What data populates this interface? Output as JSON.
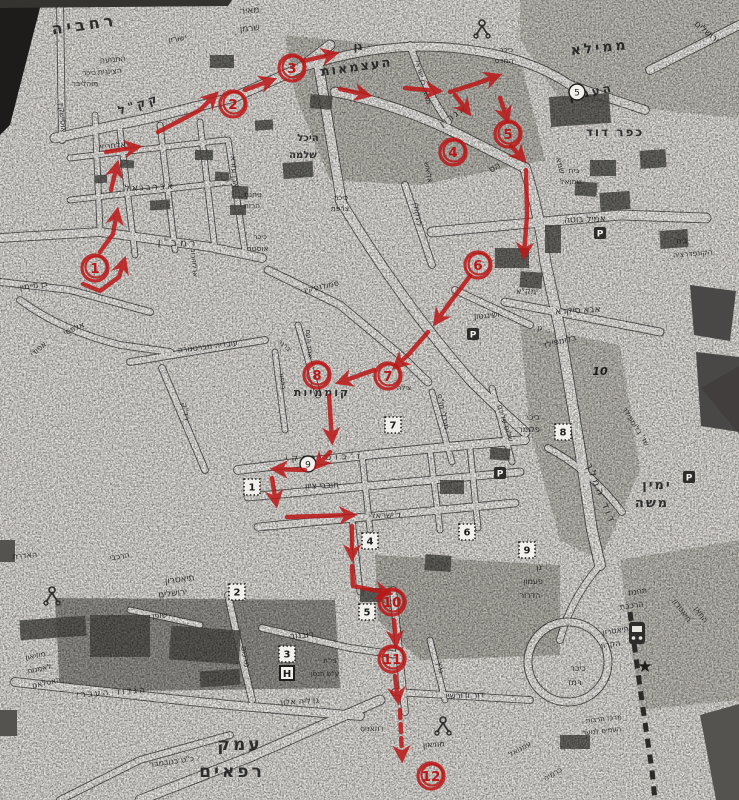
{
  "map_title": "Jerusalem city-center street map (scanned photocopy) with hand-drawn walking route",
  "route": {
    "color": "#bb1717",
    "markers": [
      {
        "n": "1",
        "x": 95,
        "y": 268
      },
      {
        "n": "2",
        "x": 233,
        "y": 104
      },
      {
        "n": "3",
        "x": 292,
        "y": 68
      },
      {
        "n": "4",
        "x": 453,
        "y": 152
      },
      {
        "n": "5",
        "x": 508,
        "y": 134
      },
      {
        "n": "6",
        "x": 478,
        "y": 265
      },
      {
        "n": "7",
        "x": 388,
        "y": 376
      },
      {
        "n": "8",
        "x": 317,
        "y": 375
      },
      {
        "n": "10",
        "x": 392,
        "y": 602
      },
      {
        "n": "11",
        "x": 392,
        "y": 659
      },
      {
        "n": "12",
        "x": 431,
        "y": 776
      }
    ],
    "arrows": [
      {
        "p": [
          [
            83,
            284
          ],
          [
            100,
            291
          ],
          [
            119,
            277
          ],
          [
            124,
            261
          ]
        ]
      },
      {
        "p": [
          [
            100,
            252
          ],
          [
            113,
            234
          ],
          [
            117,
            212
          ]
        ]
      },
      {
        "p": [
          [
            111,
            190
          ],
          [
            117,
            165
          ]
        ]
      },
      {
        "p": [
          [
            106,
            152
          ],
          [
            137,
            147
          ]
        ]
      },
      {
        "p": [
          [
            158,
            132
          ],
          [
            200,
            110
          ],
          [
            215,
            95
          ]
        ]
      },
      {
        "p": [
          [
            245,
            90
          ],
          [
            272,
            80
          ]
        ]
      },
      {
        "p": [
          [
            303,
            61
          ],
          [
            334,
            54
          ]
        ]
      },
      {
        "p": [
          [
            340,
            89
          ],
          [
            367,
            95
          ]
        ]
      },
      {
        "p": [
          [
            405,
            88
          ],
          [
            438,
            91
          ]
        ]
      },
      {
        "p": [
          [
            450,
            92
          ],
          [
            478,
            83
          ],
          [
            497,
            76
          ]
        ]
      },
      {
        "p": [
          [
            455,
            95
          ],
          [
            468,
            112
          ]
        ]
      },
      {
        "p": [
          [
            500,
            98
          ],
          [
            507,
            119
          ]
        ]
      },
      {
        "p": [
          [
            511,
            146
          ],
          [
            523,
            159
          ]
        ]
      },
      {
        "p": [
          [
            526,
            170
          ],
          [
            527,
            215
          ],
          [
            524,
            255
          ]
        ]
      },
      {
        "p": [
          [
            470,
            276
          ],
          [
            448,
            305
          ],
          [
            436,
            322
          ]
        ]
      },
      {
        "p": [
          [
            428,
            332
          ],
          [
            408,
            355
          ],
          [
            396,
            366
          ]
        ]
      },
      {
        "p": [
          [
            374,
            370
          ],
          [
            352,
            378
          ],
          [
            340,
            382
          ]
        ]
      },
      {
        "p": [
          [
            329,
            396
          ],
          [
            332,
            440
          ]
        ]
      },
      {
        "p": [
          [
            330,
            452
          ],
          [
            317,
            466
          ]
        ]
      },
      {
        "p": [
          [
            305,
            470
          ],
          [
            275,
            469
          ]
        ]
      },
      {
        "p": [
          [
            272,
            478
          ],
          [
            276,
            503
          ]
        ]
      },
      {
        "p": [
          [
            287,
            517
          ],
          [
            352,
            515
          ]
        ]
      },
      {
        "p": [
          [
            352,
            526
          ],
          [
            352,
            557
          ]
        ]
      },
      {
        "p": [
          [
            352,
            566
          ],
          [
            353,
            586
          ],
          [
            388,
            593
          ]
        ]
      },
      {
        "p": [
          [
            394,
            620
          ],
          [
            396,
            643
          ]
        ]
      },
      {
        "p": [
          [
            395,
            676
          ],
          [
            398,
            700
          ]
        ]
      },
      {
        "p": [
          [
            400,
            710
          ],
          [
            402,
            758
          ]
        ],
        "d": 1
      }
    ]
  },
  "labels": [
    {
      "t": "רחביה",
      "x": 85,
      "y": 30,
      "r": -8,
      "s": 16,
      "b": 1,
      "ls": 4
    },
    {
      "t": "ממילא",
      "x": 600,
      "y": 52,
      "r": -6,
      "s": 14,
      "b": 1,
      "ls": 3
    },
    {
      "t": "העמק",
      "x": 592,
      "y": 96,
      "r": -12,
      "s": 12,
      "b": 1,
      "ls": 3
    },
    {
      "t": "כפר דוד",
      "x": 615,
      "y": 136,
      "r": 0,
      "s": 12,
      "b": 1,
      "ls": 2
    },
    {
      "t": "ימין",
      "x": 657,
      "y": 489,
      "r": 0,
      "s": 13,
      "b": 1,
      "ls": 2
    },
    {
      "t": "משה",
      "x": 652,
      "y": 507,
      "r": 0,
      "s": 13,
      "b": 1,
      "ls": 2
    },
    {
      "t": "עמק",
      "x": 240,
      "y": 750,
      "r": 0,
      "s": 17,
      "b": 1,
      "ls": 3
    },
    {
      "t": "רפאים",
      "x": 232,
      "y": 777,
      "r": 0,
      "s": 17,
      "b": 1,
      "ls": 3
    },
    {
      "t": "קוממיות",
      "x": 322,
      "y": 396,
      "r": 0,
      "s": 11,
      "b": 1,
      "ls": 2
    },
    {
      "t": "גן",
      "x": 358,
      "y": 50,
      "r": 0,
      "s": 11,
      "b": 1
    },
    {
      "t": "העצמאות",
      "x": 357,
      "y": 71,
      "r": -8,
      "s": 13,
      "b": 1,
      "ls": 2
    },
    {
      "t": "היכל",
      "x": 308,
      "y": 141,
      "r": 0,
      "s": 10,
      "b": 1
    },
    {
      "t": "שלמה",
      "x": 303,
      "y": 158,
      "r": 0,
      "s": 10,
      "b": 1
    },
    {
      "t": "קק\"ל",
      "x": 140,
      "y": 108,
      "r": -18,
      "s": 12,
      "b": 1,
      "ls": 3
    },
    {
      "t": "אלחריזי",
      "x": 113,
      "y": 148,
      "r": -6,
      "s": 8
    },
    {
      "t": "אברבנאל",
      "x": 150,
      "y": 190,
      "r": -3,
      "s": 9,
      "ls": 2
    },
    {
      "t": "רמב\"ן",
      "x": 178,
      "y": 246,
      "r": 2,
      "s": 10,
      "ls": 3
    },
    {
      "t": "אבן עזרא",
      "x": 232,
      "y": 172,
      "r": 85,
      "s": 8
    },
    {
      "t": "בן מיימון",
      "x": 34,
      "y": 288,
      "r": -8,
      "s": 8
    },
    {
      "t": "אלפסי",
      "x": 75,
      "y": 331,
      "r": -25,
      "s": 8
    },
    {
      "t": "אפודי",
      "x": 40,
      "y": 351,
      "r": -40,
      "s": 8
    },
    {
      "t": "עובדיה מברטנורה",
      "x": 208,
      "y": 349,
      "r": -7,
      "s": 8
    },
    {
      "t": "רד\"ק",
      "x": 183,
      "y": 412,
      "r": 80,
      "s": 8
    },
    {
      "t": "סמולנסקין",
      "x": 322,
      "y": 289,
      "r": -12,
      "s": 8
    },
    {
      "t": "אחד העם",
      "x": 307,
      "y": 344,
      "r": 85,
      "s": 7
    },
    {
      "t": "ברנר",
      "x": 283,
      "y": 347,
      "r": 40,
      "s": 7
    },
    {
      "t": "בלפור",
      "x": 280,
      "y": 381,
      "r": 85,
      "s": 7
    },
    {
      "t": "ישורון",
      "x": 178,
      "y": 41,
      "r": -10,
      "s": 8
    },
    {
      "t": "מאיר",
      "x": 250,
      "y": 13,
      "r": -5,
      "s": 9
    },
    {
      "t": "שרמן",
      "x": 250,
      "y": 31,
      "r": -5,
      "s": 9
    },
    {
      "t": "כיכר",
      "x": 89,
      "y": 75,
      "r": 0,
      "s": 7.5
    },
    {
      "t": "מוהליבר",
      "x": 85,
      "y": 86,
      "r": 0,
      "s": 7.5
    },
    {
      "t": "התנועה",
      "x": 113,
      "y": 62,
      "r": -5,
      "s": 8
    },
    {
      "t": "הציונית",
      "x": 110,
      "y": 74,
      "r": -5,
      "s": 8
    },
    {
      "t": "אוסישקין",
      "x": 60,
      "y": 118,
      "r": 85,
      "s": 8
    },
    {
      "t": "טחנת",
      "x": 253,
      "y": 197,
      "r": 0,
      "s": 7.5
    },
    {
      "t": "הרוח",
      "x": 252,
      "y": 208,
      "r": 0,
      "s": 7.5
    },
    {
      "t": "כיכר",
      "x": 260,
      "y": 239,
      "r": 0,
      "s": 7.5
    },
    {
      "t": "אוסטר",
      "x": 258,
      "y": 251,
      "r": 0,
      "s": 7.5
    },
    {
      "t": "ארלוזורוב",
      "x": 192,
      "y": 263,
      "r": 85,
      "s": 7
    },
    {
      "t": "כיכר",
      "x": 341,
      "y": 200,
      "r": 0,
      "s": 7.5
    },
    {
      "t": "צרפת",
      "x": 340,
      "y": 211,
      "r": 0,
      "s": 7.5
    },
    {
      "t": "אגרון",
      "x": 455,
      "y": 118,
      "r": -35,
      "s": 10,
      "ls": 2
    },
    {
      "t": "מנשה בן ישראל",
      "x": 421,
      "y": 82,
      "r": 75,
      "s": 7
    },
    {
      "t": "כיכר",
      "x": 506,
      "y": 52,
      "r": 0,
      "s": 7.5
    },
    {
      "t": "המכס",
      "x": 504,
      "y": 63,
      "r": 0,
      "s": 7.5
    },
    {
      "t": "ירושלים",
      "x": 705,
      "y": 34,
      "r": 40,
      "s": 9
    },
    {
      "t": "לינקולן",
      "x": 415,
      "y": 215,
      "r": 80,
      "s": 8
    },
    {
      "t": "אליאש",
      "x": 426,
      "y": 173,
      "r": 80,
      "s": 7.5
    },
    {
      "t": "הס",
      "x": 496,
      "y": 170,
      "r": -30,
      "s": 9
    },
    {
      "t": "שמא",
      "x": 558,
      "y": 166,
      "r": 75,
      "s": 8
    },
    {
      "t": "בית",
      "x": 574,
      "y": 173,
      "r": 0,
      "s": 7.5
    },
    {
      "t": "שמואל",
      "x": 571,
      "y": 184,
      "r": 0,
      "s": 7.5
    },
    {
      "t": "אמיל בוטה",
      "x": 585,
      "y": 222,
      "r": -2,
      "s": 9
    },
    {
      "t": "בית",
      "x": 682,
      "y": 243,
      "r": -5,
      "s": 7.5
    },
    {
      "t": "הקונפדרציה",
      "x": 693,
      "y": 256,
      "r": -5,
      "s": 7.5
    },
    {
      "t": "אבא סיקרא",
      "x": 578,
      "y": 313,
      "r": -3,
      "s": 9
    },
    {
      "t": "ושינגטון",
      "x": 487,
      "y": 318,
      "r": -5,
      "s": 8
    },
    {
      "t": "ימק\"א",
      "x": 527,
      "y": 294,
      "r": 0,
      "s": 8
    },
    {
      "t": "גן",
      "x": 540,
      "y": 330,
      "r": 0,
      "s": 7
    },
    {
      "t": "בלומפילד",
      "x": 560,
      "y": 344,
      "r": -14,
      "s": 8.5
    },
    {
      "t": "שלום עליכם",
      "x": 503,
      "y": 424,
      "r": 72,
      "s": 7.5
    },
    {
      "t": "מנדלי מו\"ס",
      "x": 441,
      "y": 412,
      "r": 78,
      "s": 7.5
    },
    {
      "t": "כיכר",
      "x": 532,
      "y": 420,
      "r": 0,
      "s": 8
    },
    {
      "t": "פלומר",
      "x": 529,
      "y": 432,
      "r": 0,
      "s": 8
    },
    {
      "t": "שד' בלומפילד",
      "x": 634,
      "y": 428,
      "r": 58,
      "s": 7.5
    },
    {
      "t": "דוד המלך",
      "x": 598,
      "y": 495,
      "r": 68,
      "s": 10,
      "ls": 3
    },
    {
      "t": "ז'בוטינסקי",
      "x": 325,
      "y": 460,
      "r": -2,
      "s": 9,
      "ls": 4
    },
    {
      "t": "חובבי ציון",
      "x": 322,
      "y": 488,
      "r": -2,
      "s": 8.5
    },
    {
      "t": "ד'ישראלי",
      "x": 385,
      "y": 518,
      "r": -2,
      "s": 8.5
    },
    {
      "t": "צילה",
      "x": 404,
      "y": 390,
      "r": 0,
      "s": 7
    },
    {
      "t": "האדרת",
      "x": 25,
      "y": 558,
      "r": -5,
      "s": 8
    },
    {
      "t": "הרכבי",
      "x": 120,
      "y": 559,
      "r": -8,
      "s": 8
    },
    {
      "t": "תיאטרון",
      "x": 180,
      "y": 582,
      "r": -7,
      "s": 9
    },
    {
      "t": "ירושלים",
      "x": 173,
      "y": 596,
      "r": -7,
      "s": 9
    },
    {
      "t": "שופן",
      "x": 160,
      "y": 618,
      "r": -5,
      "s": 8
    },
    {
      "t": "מרכוס",
      "x": 243,
      "y": 657,
      "r": 80,
      "s": 8
    },
    {
      "t": "דובנוב",
      "x": 302,
      "y": 638,
      "r": -4,
      "s": 9
    },
    {
      "t": "בי\"ח",
      "x": 330,
      "y": 663,
      "r": 0,
      "s": 7
    },
    {
      "t": "ע\"ש הנסן",
      "x": 325,
      "y": 676,
      "r": 0,
      "s": 7
    },
    {
      "t": "הגדוד העברי",
      "x": 112,
      "y": 695,
      "r": -4,
      "s": 9,
      "ls": 2
    },
    {
      "t": "גדליה אלון",
      "x": 300,
      "y": 704,
      "r": -3,
      "s": 8.5
    },
    {
      "t": "מוזיאון",
      "x": 36,
      "y": 658,
      "r": -12,
      "s": 7.5
    },
    {
      "t": "לאמנות",
      "x": 40,
      "y": 671,
      "r": -12,
      "s": 7.5
    },
    {
      "t": "האסלאם",
      "x": 47,
      "y": 685,
      "r": -12,
      "s": 7.5
    },
    {
      "t": "כ\"ט בנובמבר",
      "x": 172,
      "y": 764,
      "r": -8,
      "s": 8
    },
    {
      "t": "גן",
      "x": 539,
      "y": 570,
      "r": 0,
      "s": 8
    },
    {
      "t": "פעמון",
      "x": 533,
      "y": 584,
      "r": 0,
      "s": 8
    },
    {
      "t": "הדרור",
      "x": 530,
      "y": 598,
      "r": 0,
      "s": 8
    },
    {
      "t": "תיאטרון",
      "x": 616,
      "y": 633,
      "r": -8,
      "s": 8
    },
    {
      "t": "הקרון",
      "x": 611,
      "y": 647,
      "r": -8,
      "s": 8
    },
    {
      "t": "כיכר",
      "x": 578,
      "y": 671,
      "r": 0,
      "s": 8.5
    },
    {
      "t": "רמז",
      "x": 575,
      "y": 685,
      "r": 0,
      "s": 8.5
    },
    {
      "t": "תחנת",
      "x": 638,
      "y": 594,
      "r": -8,
      "s": 8
    },
    {
      "t": "הרכבת",
      "x": 632,
      "y": 608,
      "r": -8,
      "s": 8
    },
    {
      "t": "תיאטרון",
      "x": 680,
      "y": 612,
      "r": 55,
      "s": 8
    },
    {
      "t": "החאן",
      "x": 699,
      "y": 616,
      "r": 55,
      "s": 8
    },
    {
      "t": "דור ודורשיו",
      "x": 465,
      "y": 698,
      "r": -2,
      "s": 8.5
    },
    {
      "t": "רוזאניס",
      "x": 372,
      "y": 731,
      "r": -2,
      "s": 7.5
    },
    {
      "t": "מוזיאון",
      "x": 434,
      "y": 747,
      "r": -5,
      "s": 8
    },
    {
      "t": "עמנואל",
      "x": 521,
      "y": 751,
      "r": -30,
      "s": 7.5
    },
    {
      "t": "כרמיה",
      "x": 554,
      "y": 776,
      "r": -30,
      "s": 7.5
    },
    {
      "t": "גרץ",
      "x": 438,
      "y": 668,
      "r": 80,
      "s": 8
    },
    {
      "t": "מרכז תרבות",
      "x": 604,
      "y": 721,
      "r": -6,
      "s": 7
    },
    {
      "t": "העמים לנוער",
      "x": 602,
      "y": 733,
      "r": -6,
      "s": 7
    }
  ],
  "symbols": [
    {
      "type": "parking",
      "x": 600,
      "y": 233
    },
    {
      "type": "parking",
      "x": 473,
      "y": 334
    },
    {
      "type": "parking",
      "x": 500,
      "y": 473
    },
    {
      "type": "parking",
      "x": 689,
      "y": 477
    },
    {
      "type": "hospital",
      "x": 287,
      "y": 673
    },
    {
      "type": "dotnum",
      "n": "1",
      "x": 252,
      "y": 487
    },
    {
      "type": "dotnum",
      "n": "2",
      "x": 237,
      "y": 592
    },
    {
      "type": "dotnum",
      "n": "3",
      "x": 287,
      "y": 654
    },
    {
      "type": "dotnum",
      "n": "4",
      "x": 370,
      "y": 541
    },
    {
      "type": "dotnum",
      "n": "5",
      "x": 367,
      "y": 612
    },
    {
      "type": "dotnum",
      "n": "6",
      "x": 467,
      "y": 532
    },
    {
      "type": "dotnum",
      "n": "7",
      "x": 393,
      "y": 425
    },
    {
      "type": "dotnum",
      "n": "8",
      "x": 563,
      "y": 432
    },
    {
      "type": "dotnum",
      "n": "9",
      "x": 527,
      "y": 550
    },
    {
      "type": "pcircle",
      "n": "5",
      "x": 577,
      "y": 92
    },
    {
      "type": "pcircle",
      "n": "9",
      "x": 308,
      "y": 464
    },
    {
      "type": "inum",
      "n": "10",
      "x": 600,
      "y": 375
    },
    {
      "type": "train",
      "x": 637,
      "y": 633
    },
    {
      "type": "star",
      "x": 645,
      "y": 666
    },
    {
      "type": "monument",
      "x": 482,
      "y": 28
    },
    {
      "type": "monument",
      "x": 443,
      "y": 725
    },
    {
      "type": "monument",
      "x": 52,
      "y": 595
    }
  ]
}
